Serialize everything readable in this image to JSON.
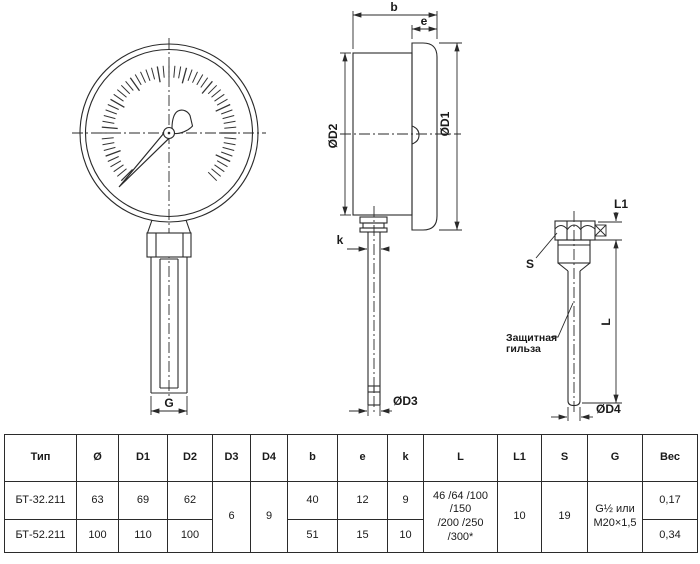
{
  "colors": {
    "line": "#2a2a2a",
    "background": "#ffffff"
  },
  "drawing": {
    "labels": {
      "b": "b",
      "e": "e",
      "d1": "ØD1",
      "d2": "ØD2",
      "k": "k",
      "d3": "ØD3",
      "g": "G",
      "l1": "L1",
      "l": "L",
      "s": "S",
      "d4": "ØD4",
      "sleeve_line1": "Защитная",
      "sleeve_line2": "гильза"
    }
  },
  "table": {
    "headers": [
      "Тип",
      "Ø",
      "D1",
      "D2",
      "D3",
      "D4",
      "b",
      "e",
      "k",
      "L",
      "L1",
      "S",
      "G",
      "Вес"
    ],
    "rows": [
      {
        "type": "БТ-32.211",
        "diameter": "63",
        "d1": "69",
        "d2": "62",
        "b": "40",
        "e": "12",
        "k": "9",
        "weight": "0,17"
      },
      {
        "type": "БТ-52.211",
        "diameter": "100",
        "d1": "110",
        "d2": "100",
        "b": "51",
        "e": "15",
        "k": "10",
        "weight": "0,34"
      }
    ],
    "merged": {
      "d3": "6",
      "d4": "9",
      "l_line1": "46 /64 /100 /150",
      "l_line2": "/200 /250 /300*",
      "l1": "10",
      "s": "19",
      "g_line1": "G½ или",
      "g_line2": "M20×1,5"
    }
  }
}
